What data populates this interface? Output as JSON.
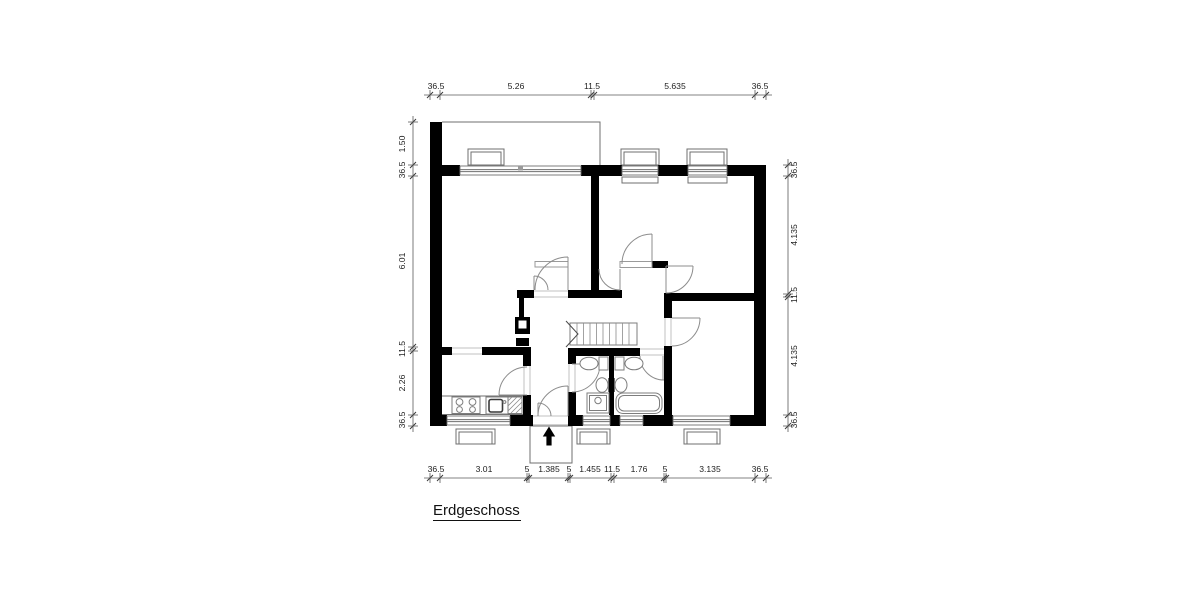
{
  "drawing": {
    "title": "Erdgeschoss"
  },
  "colors": {
    "background": "#ffffff",
    "wall": "#000000",
    "fixture_line": "#7d7d7d",
    "dimension_line": "#5a5a5a",
    "text": "#1d1d1d"
  },
  "icons": {
    "entrance-arrow": "up-arrow"
  },
  "dims": {
    "top": {
      "orient": "h",
      "line": 95,
      "from": 424,
      "to": 772,
      "label_off": 89,
      "ticks": [
        430,
        440,
        591,
        594,
        755,
        766
      ],
      "labels": [
        {
          "t": "36.5",
          "p": 436
        },
        {
          "t": "5.26",
          "p": 516
        },
        {
          "t": "11.5",
          "p": 592
        },
        {
          "t": "5.635",
          "p": 675
        },
        {
          "t": "36.5",
          "p": 760
        }
      ]
    },
    "bottom": {
      "orient": "h",
      "line": 478,
      "from": 424,
      "to": 772,
      "label_off": 472,
      "ticks": [
        430,
        440,
        527,
        529,
        568,
        570,
        611,
        614,
        664,
        666,
        755,
        766
      ],
      "labels": [
        {
          "t": "36.5",
          "p": 436
        },
        {
          "t": "3.01",
          "p": 484
        },
        {
          "t": "5",
          "p": 527
        },
        {
          "t": "1.385",
          "p": 549
        },
        {
          "t": "5",
          "p": 569
        },
        {
          "t": "1.455",
          "p": 590
        },
        {
          "t": "11.5",
          "p": 612
        },
        {
          "t": "1.76",
          "p": 639
        },
        {
          "t": "5",
          "p": 665
        },
        {
          "t": "3.135",
          "p": 710
        },
        {
          "t": "36.5",
          "p": 760
        }
      ]
    },
    "left": {
      "orient": "v",
      "line": 413,
      "from": 116,
      "to": 432,
      "label_off": 405,
      "ticks": [
        122,
        165,
        176,
        347,
        351,
        415,
        426
      ],
      "labels": [
        {
          "t": "1.50",
          "p": 144
        },
        {
          "t": "36.5",
          "p": 170
        },
        {
          "t": "6.01",
          "p": 261
        },
        {
          "t": "11.5",
          "p": 349
        },
        {
          "t": "2.26",
          "p": 383
        },
        {
          "t": "36.5",
          "p": 420
        }
      ]
    },
    "right": {
      "orient": "v",
      "line": 788,
      "from": 159,
      "to": 432,
      "label_off": 797,
      "ticks": [
        165,
        176,
        294,
        297,
        415,
        426
      ],
      "labels": [
        {
          "t": "36.5",
          "p": 170
        },
        {
          "t": "4.135",
          "p": 235
        },
        {
          "t": "11.5",
          "p": 295
        },
        {
          "t": "4.135",
          "p": 356
        },
        {
          "t": "36.5",
          "p": 420
        }
      ]
    }
  }
}
